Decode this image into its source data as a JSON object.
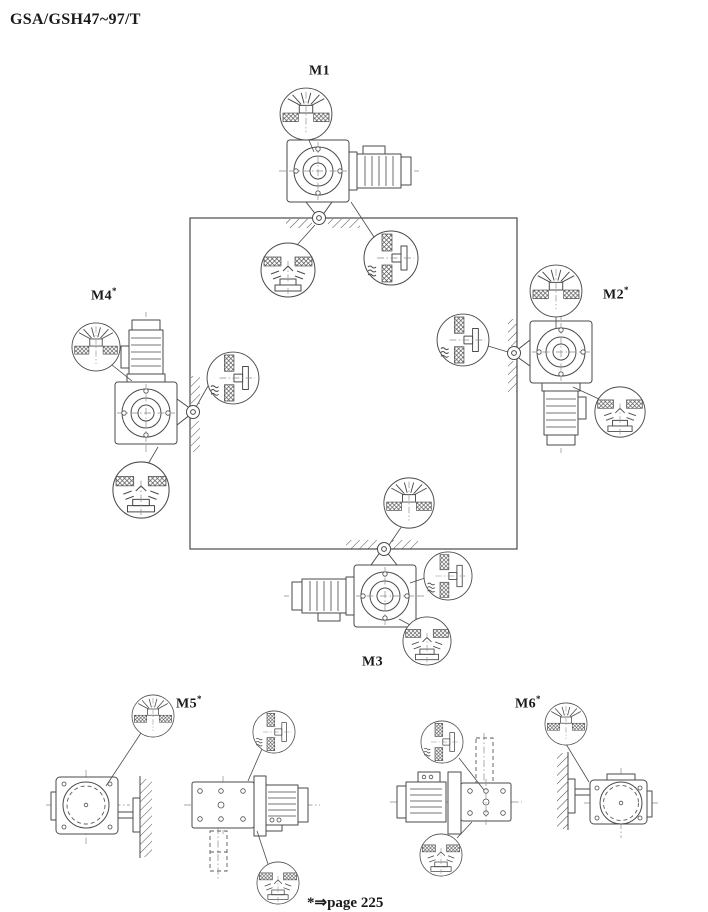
{
  "page": {
    "title": "GSA/GSH47~97/T",
    "footnote": {
      "star": "*",
      "arrow": "⇒",
      "text": "page 225"
    }
  },
  "positions": {
    "m1": {
      "label": "M1",
      "sup": ""
    },
    "m2": {
      "label": "M2",
      "sup": "*"
    },
    "m3": {
      "label": "M3",
      "sup": ""
    },
    "m4": {
      "label": "M4",
      "sup": "*"
    },
    "m5": {
      "label": "M5",
      "sup": "*"
    },
    "m6": {
      "label": "M6",
      "sup": "*"
    }
  },
  "icons": {
    "breather_callout": "breather-vent-plug-detail",
    "oil_level_callout": "oil-level-plug-detail",
    "drain_callout": "oil-drain-plug-detail"
  },
  "colors": {
    "line": "#4a4a4a",
    "label": "#1a1a1a",
    "background": "#ffffff"
  }
}
